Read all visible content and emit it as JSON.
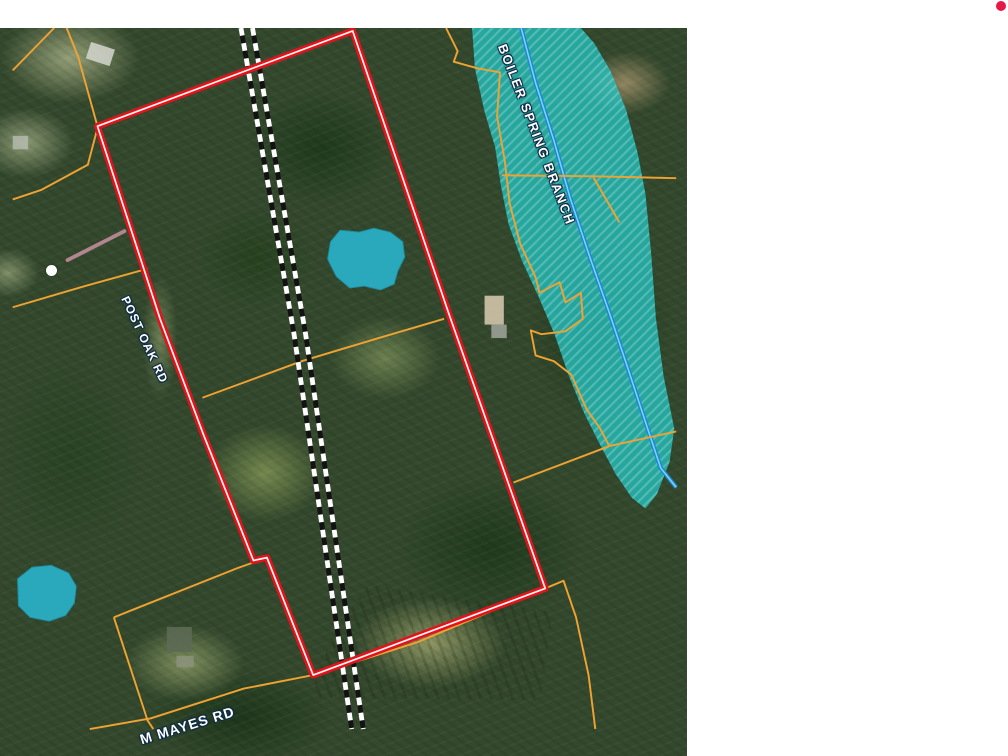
{
  "map": {
    "labels": {
      "flood_zone": "BOILER SPRING BRANCH",
      "road_left": "POST OAK RD",
      "road_bottom": "M MAYES RD"
    },
    "colors": {
      "selected_parcel_outline": "#e3131b",
      "selected_parcel_casing": "#ffffff",
      "parcel_lines": "#f0a232",
      "flood_zone_fill": "#23c2bf",
      "pond_fill": "#2aa9bd",
      "stream_casing": "#1c86d8",
      "stream_center": "#7fd4f0",
      "railroad_dark": "#121212",
      "railroad_light": "#ffffff",
      "measure_line": "#c08d9b",
      "measure_dot": "#ffffff",
      "notification_dot": "#e8174a"
    }
  }
}
